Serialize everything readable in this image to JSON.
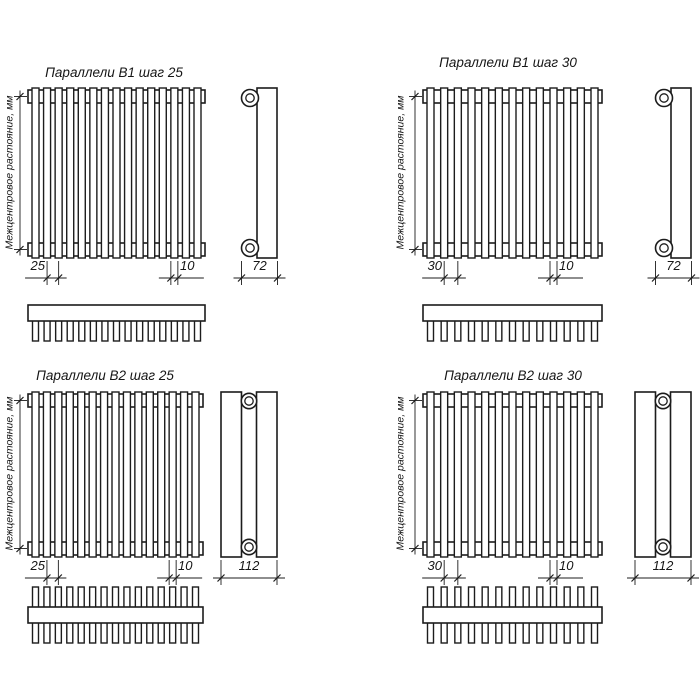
{
  "drawing": {
    "background": "#ffffff",
    "line_color": "#1c1c1c",
    "axis_label": "Межцентровое растояние, мм",
    "quadrants": [
      {
        "id": "b1-step-25",
        "title": "Параллели В1 шаг 25",
        "step_dim": "25",
        "tube_dim": "10",
        "depth_dim": "72",
        "tube_count": 15,
        "teeth_count": 15,
        "rows": 1
      },
      {
        "id": "b1-step-30",
        "title": "Параллели В1 шаг 30",
        "step_dim": "30",
        "tube_dim": "10",
        "depth_dim": "72",
        "tube_count": 13,
        "teeth_count": 13,
        "rows": 1
      },
      {
        "id": "b2-step-25",
        "title": "Параллели В2 шаг 25",
        "step_dim": "25",
        "tube_dim": "10",
        "depth_dim": "112",
        "tube_count": 15,
        "teeth_count": 15,
        "rows": 2
      },
      {
        "id": "b2-step-30",
        "title": "Параллели В2 шаг 30",
        "step_dim": "30",
        "tube_dim": "10",
        "depth_dim": "112",
        "tube_count": 13,
        "teeth_count": 13,
        "rows": 2
      }
    ]
  }
}
